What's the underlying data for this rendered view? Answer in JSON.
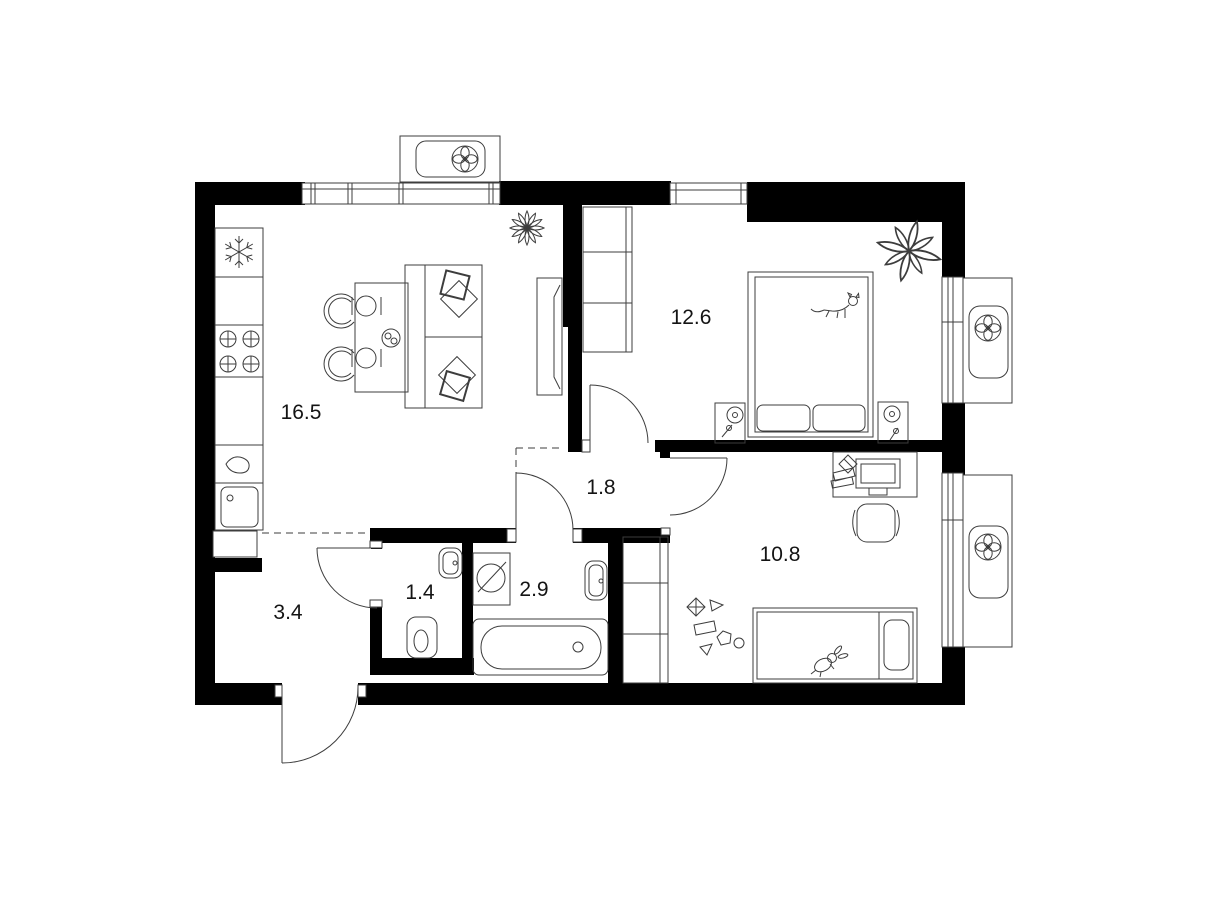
{
  "colors": {
    "background": "#ffffff",
    "walls": "#000000",
    "lines": "#3d3d3d",
    "label_text": "#141414"
  },
  "rooms": {
    "kitchen_living": {
      "area_label": "16.5"
    },
    "bedroom": {
      "area_label": "12.6"
    },
    "hall": {
      "area_label": "1.8"
    },
    "kids_room": {
      "area_label": "10.8"
    },
    "corridor": {
      "area_label": "3.4"
    },
    "wc": {
      "area_label": "1.4"
    },
    "bathroom": {
      "area_label": "2.9"
    }
  },
  "icons": {
    "fan": "fan-icon",
    "snowflake": "snowflake-icon",
    "stove_burner": "stove-burner-icon",
    "plant": "plant-icon"
  }
}
